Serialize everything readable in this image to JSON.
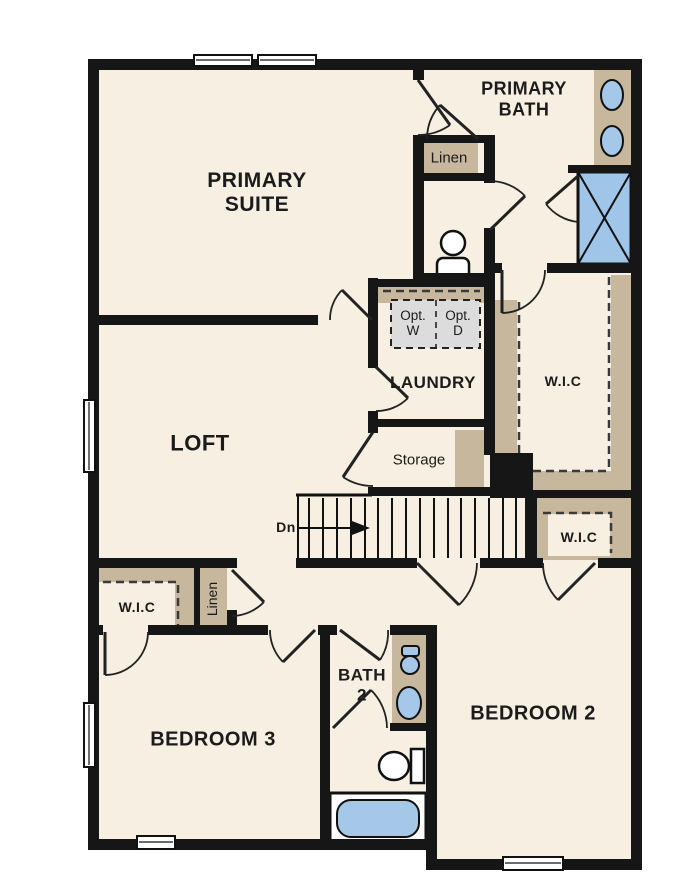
{
  "colors": {
    "wall": "#161616",
    "floor": "#f6efe2",
    "closet": "#c7b79c",
    "fixture": "#a5c8e8",
    "optional_fill": "#dcdcdc",
    "background": "#ffffff"
  },
  "rooms": {
    "primary_suite": {
      "label": "PRIMARY SUITE"
    },
    "primary_bath": {
      "label": "PRIMARY BATH"
    },
    "loft": {
      "label": "LOFT"
    },
    "laundry": {
      "label": "LAUNDRY",
      "optional_washer": "Opt. W",
      "optional_dryer": "Opt. D"
    },
    "storage": {
      "label": "Storage"
    },
    "linen_upper": {
      "label": "Linen"
    },
    "linen_hall": {
      "label": "Linen"
    },
    "wic_primary": {
      "label": "W.I.C"
    },
    "wic_bedroom2": {
      "label": "W.I.C"
    },
    "wic_bedroom3": {
      "label": "W.I.C"
    },
    "bath2": {
      "label": "BATH 2"
    },
    "bedroom2": {
      "label": "BEDROOM 2"
    },
    "bedroom3": {
      "label": "BEDROOM 3"
    }
  },
  "stairs": {
    "direction_label": "Dn"
  },
  "fixtures": {
    "primary_bath": [
      "double-vanity-sinks",
      "shower",
      "water-closet-toilet"
    ],
    "bath2": [
      "vanity-toilet-icon",
      "vanity-sink",
      "toilet",
      "bathtub"
    ]
  }
}
